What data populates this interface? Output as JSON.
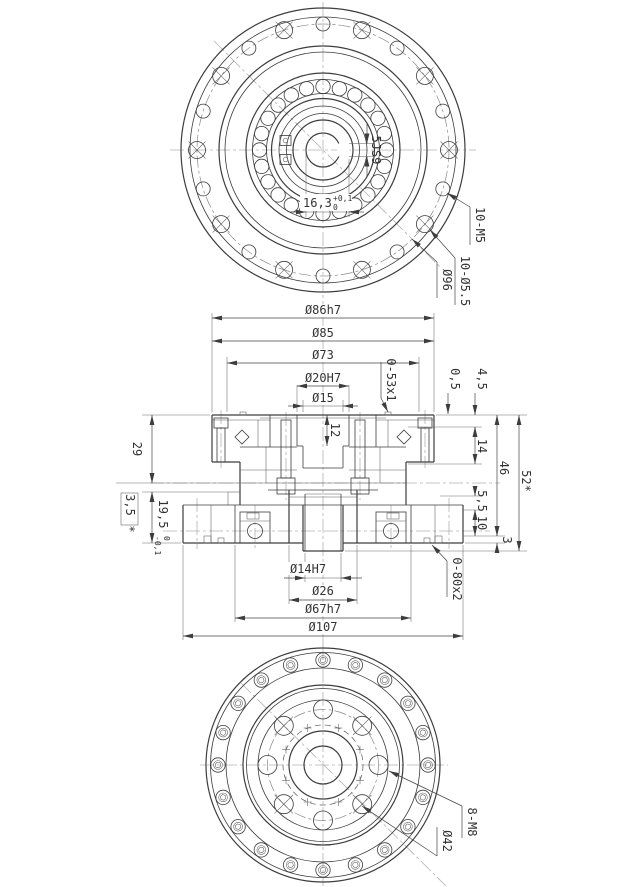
{
  "colors": {
    "line": "#3d3d3d",
    "thin_line": "#5a5a5a",
    "centerline": "#b3b3b3",
    "text": "#333333",
    "background": "#ffffff"
  },
  "top_view": {
    "keyway_width": "5JS9",
    "keyway_depth": "16,3",
    "keyway_depth_tol_upper": "+0,1",
    "keyway_depth_tol_lower": "0",
    "thread_holes_label": "10-M5",
    "clearance_holes_label": "10-Ø5.5",
    "bolt_circle_label": "Ø96"
  },
  "section_view": {
    "dia_86": "Ø86h7",
    "dia_85": "Ø85",
    "dia_73": "Ø73",
    "dia_20": "Ø20H7",
    "dia_15": "Ø15",
    "oring_top_label": "0-53x1",
    "step_05": "0,5",
    "step_45": "4,5",
    "depth_14": "14",
    "height_46": "46",
    "height_52": "52*",
    "step_55": "5,5",
    "step_10": "10",
    "step_3": "3",
    "height_29": "29",
    "ref_35": "3,5",
    "ref_35_star": "*",
    "depth_195": "19,5",
    "depth_195_tol_upper": "0",
    "depth_195_tol_lower": "-0,1",
    "depth_12": "12",
    "dia_14": "Ø14H7",
    "dia_26": "Ø26",
    "dia_67": "Ø67h7",
    "dia_107": "Ø107",
    "oring_bottom_label": "0-80x2"
  },
  "bottom_view": {
    "thread_holes_label": "8-M8",
    "bolt_circle_label": "Ø42"
  }
}
